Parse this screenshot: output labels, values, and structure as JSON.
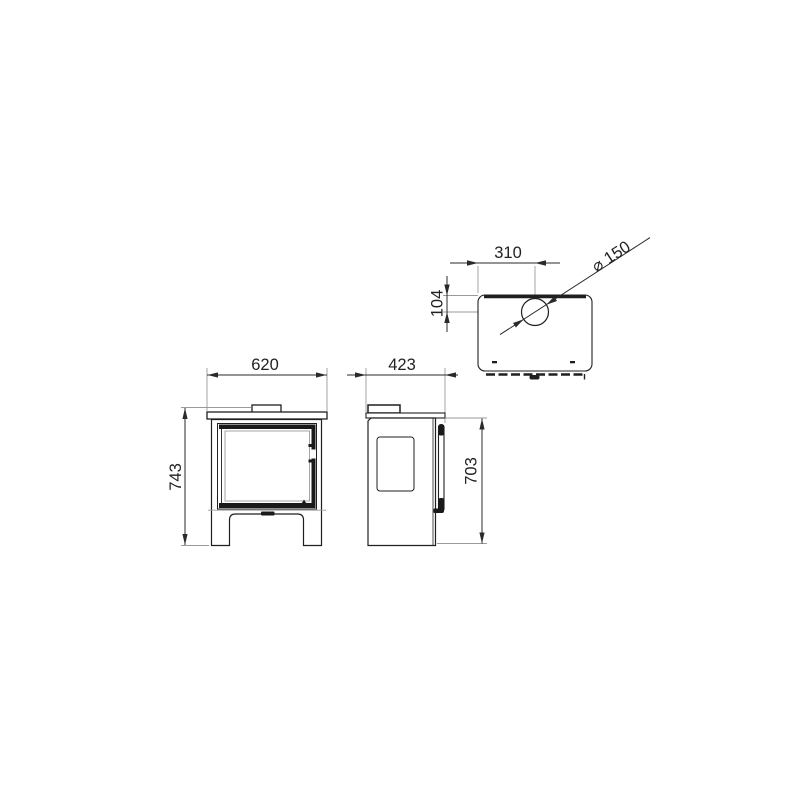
{
  "drawing": {
    "kind": "three-view technical dimension drawing of a wood-burning stove",
    "views": {
      "front": {
        "label_width": "620",
        "label_height": "743"
      },
      "side": {
        "label_depth": "423",
        "label_height": "703"
      },
      "top": {
        "label_flue_offset_x": "310",
        "label_flue_offset_y": "104",
        "label_flue_diameter": "⌀ 150"
      }
    }
  },
  "colors": {
    "outline": "#1f1f1f",
    "dimension_line": "#2a2a2a",
    "extension_line": "#9a9a9a",
    "fill": "#ffffff",
    "text": "#222222"
  }
}
